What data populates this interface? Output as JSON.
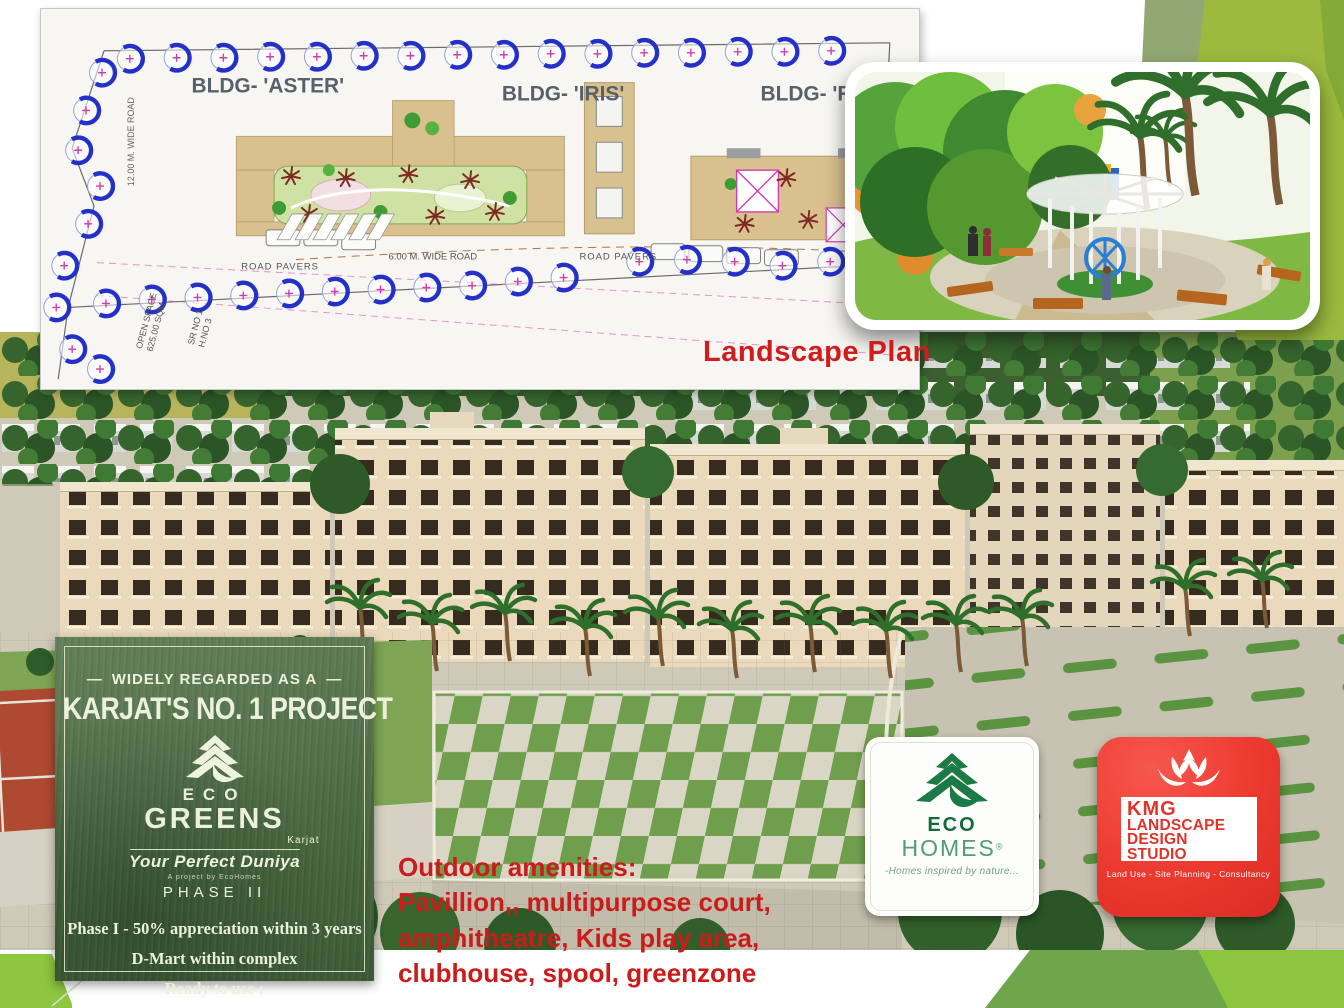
{
  "plan": {
    "caption": "Landscape Plan",
    "bldg_aster": "BLDG- 'ASTER'",
    "bldg_iris": "BLDG- 'IRIS'",
    "bldg_rosa": "BLDG- 'ROSA'",
    "road_12m": "12.00 M. WIDE  ROAD",
    "road_pavers_left": "ROAD PAVERS",
    "road_pavers_right": "ROAD PAVERS",
    "road_6m": "6.00 M. WIDE  ROAD",
    "open_space": "OPEN SPACE",
    "open_space_area": "625.00 SQM",
    "survey_line1": "SR NO 1",
    "survey_line2": "H.NO 3"
  },
  "promo": {
    "dash": "—",
    "tagline": "WIDELY REGARDED AS A",
    "title": "KARJAT'S NO. 1 PROJECT",
    "brand_eco": "ECO",
    "brand_greens": "GREENS",
    "brand_location": "Karjat",
    "slogan": "Your Perfect Duniya",
    "project_by": "A project by EcoHomes",
    "phase": "PHASE II",
    "features": [
      "Phase I - 50% appreciation within 3 years",
      "D-Mart within complex",
      "Ready to use :",
      "Swimming Pool, Club House, Play Area"
    ]
  },
  "amenities": {
    "heading": "Outdoor amenities:",
    "lines": [
      "Pavillion,, multipurpose court,",
      "amphitheatre, Kids play area,",
      "clubhouse, spool, greenzone"
    ]
  },
  "logos": {
    "eco_homes": {
      "name1": "ECO",
      "name2": "HOMES",
      "reg": "®",
      "slogan": "-Homes inspired by nature..."
    },
    "kmg": {
      "name": "KMG",
      "line1": "LANDSCAPE",
      "line2": "DESIGN",
      "line3": "STUDIO",
      "tagline": "Land Use - Site Planning - Consultancy"
    }
  },
  "colors": {
    "accent_green_bright": "#8dc63f",
    "accent_green_mid": "#6fa54b",
    "accent_green_sage": "#92a872",
    "headline_red": "#cf1d1d",
    "kmg_red": "#ec392f",
    "eco_dark_green": "#166a3f",
    "eco_mid_green": "#4f9d70",
    "promo_overlay_green": "#4e6c47",
    "promo_cream": "#ecf2da"
  }
}
